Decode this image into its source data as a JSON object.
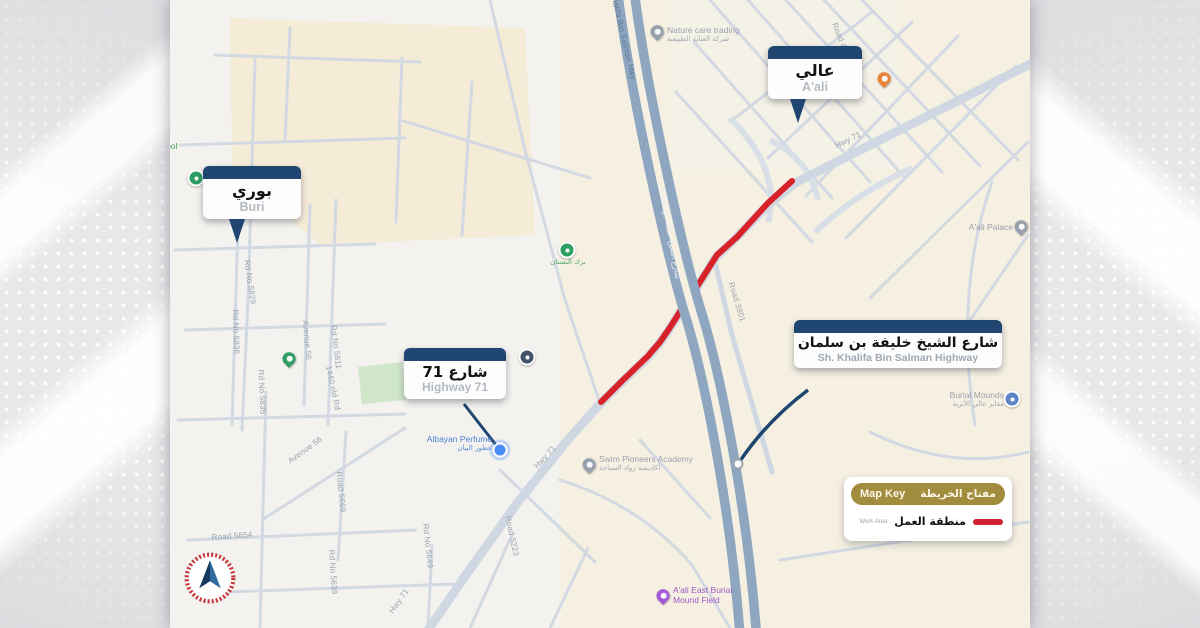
{
  "map": {
    "callouts": {
      "aali": {
        "ar": "عالي",
        "en": "A'ali"
      },
      "buri": {
        "ar": "بوري",
        "en": "Buri"
      },
      "highway71": {
        "ar": "شارع 71",
        "en": "Highway 71"
      },
      "khalifa": {
        "ar": "شارع الشيخ خليفة بن سلمان",
        "en": "Sh. Khalifa Bin Salman Highway"
      }
    },
    "key": {
      "title_en": "Map Key",
      "title_ar": "مفتاح الخريطة",
      "work_area_en": "Work Area",
      "work_area_ar": "منطقة العمل",
      "swatch_color": "#cf2030"
    },
    "colors": {
      "callout_header": "#1e4670",
      "key_header": "#a28c3e",
      "work_area_route": "#d8222a",
      "highway": "#8ea6c0"
    },
    "pois": [
      {
        "name": "nature-care-trading",
        "icon": "pin",
        "color": "#97a1ad",
        "x": 487,
        "y": 33,
        "dx": 10,
        "dy": -8,
        "align": "left",
        "label_color": "#98a1ac",
        "label_en": "Nature care trading",
        "label_ar": "شركة العناية الطبيعية"
      },
      {
        "name": "pool-label",
        "icon": "none",
        "x": 0,
        "y": 147,
        "dx": -4,
        "dy": -6,
        "align": "left",
        "label_color": "#3f9e58",
        "label_en": "ool",
        "label_ar": ""
      },
      {
        "name": "bustan-ponds",
        "icon": "circle-badge",
        "color": "#2f9e63",
        "x": 397,
        "y": 250,
        "dx": -55,
        "dy": 8,
        "align": "center",
        "label_color": "#3f9e58",
        "label_en": "",
        "label_ar": "برك البستان"
      },
      {
        "name": "mosque-buri",
        "icon": "circle-badge",
        "color": "#2f9e63",
        "x": 26,
        "y": 178,
        "label_en": "",
        "label_ar": ""
      },
      {
        "name": "mosque-park",
        "icon": "pin",
        "color": "#2f9e63",
        "x": 119,
        "y": 360,
        "label_en": "",
        "label_ar": ""
      },
      {
        "name": "albayan-perfume",
        "icon": "dot",
        "color": "#4a8af4",
        "x": 330,
        "y": 450,
        "dx": -120,
        "dy": -16,
        "align": "right",
        "label_color": "#4a7fd4",
        "label_en": "Albayan Perfume",
        "label_ar": "عطور البيان"
      },
      {
        "name": "swim-pioneers-academy",
        "icon": "pin",
        "color": "#97a1ad",
        "x": 419,
        "y": 466,
        "dx": 10,
        "dy": -12,
        "align": "left",
        "label_color": "#98a1ac",
        "label_en": "Swim Pioneers Academy",
        "label_ar": "أكاديمية رواد السباحة"
      },
      {
        "name": "aali-palace",
        "icon": "pin",
        "color": "#97a1ad",
        "x": 851,
        "y": 228,
        "dx": -120,
        "dy": -6,
        "align": "right",
        "label_color": "#98a1ac",
        "label_en": "A'ali Palace",
        "label_ar": ""
      },
      {
        "name": "burial-mounds",
        "icon": "circle-badge",
        "color": "#5b84c4",
        "x": 842,
        "y": 399,
        "dx": -120,
        "dy": -9,
        "align": "right",
        "label_color": "#98a1ac",
        "label_en": "Burial Mounds",
        "label_ar": "مقابر عالي الأثرية"
      },
      {
        "name": "aali-east-burial-mound-field",
        "icon": "pin",
        "color": "#a558d8",
        "x": 493,
        "y": 597,
        "dx": 10,
        "dy": -12,
        "align": "left",
        "label_color": "#9b59c7",
        "label_en": "A'ali East Burial\nMound Field",
        "label_ar": ""
      },
      {
        "name": "restaurant-aali",
        "icon": "pin",
        "color": "#e8833a",
        "x": 714,
        "y": 80,
        "label_en": "",
        "label_ar": ""
      },
      {
        "name": "poi-marker-navy",
        "icon": "circle-badge",
        "color": "#44536b",
        "x": 357,
        "y": 357,
        "label_en": "",
        "label_ar": ""
      }
    ],
    "road_labels": [
      {
        "text": "Hwy 71",
        "x": 678,
        "y": 140,
        "rot": -27
      },
      {
        "text": "Road 4042",
        "x": 672,
        "y": 42,
        "rot": 68
      },
      {
        "text": "Hwy 71",
        "x": 375,
        "y": 457,
        "rot": -48
      },
      {
        "text": "Hwy 71",
        "x": 229,
        "y": 601,
        "rot": -55
      },
      {
        "text": "Road 3801",
        "x": 567,
        "y": 302,
        "rot": 73
      },
      {
        "text": "Rd No 5829",
        "x": 80,
        "y": 282,
        "rot": 82
      },
      {
        "text": "Rd No 5836",
        "x": 66,
        "y": 332,
        "rot": 88
      },
      {
        "text": "Avenue 56",
        "x": 137,
        "y": 340,
        "rot": 85
      },
      {
        "text": "Rd No 5811",
        "x": 166,
        "y": 347,
        "rot": 83
      },
      {
        "text": "1440 old Rd",
        "x": 163,
        "y": 388,
        "rot": 78
      },
      {
        "text": "Rd No 5835",
        "x": 92,
        "y": 392,
        "rot": 87
      },
      {
        "text": "Avenue 56",
        "x": 135,
        "y": 450,
        "rot": -36
      },
      {
        "text": "Road 5669",
        "x": 171,
        "y": 492,
        "rot": 84
      },
      {
        "text": "Road 5654",
        "x": 62,
        "y": 536,
        "rot": -4
      },
      {
        "text": "Rd No 5649",
        "x": 258,
        "y": 546,
        "rot": 84
      },
      {
        "text": "Road 5223",
        "x": 342,
        "y": 536,
        "rot": 78
      },
      {
        "text": "Rd No 5639",
        "x": 163,
        "y": 572,
        "rot": 86
      },
      {
        "text": "Sh Khalifa Bin Salman Hwy",
        "x": 452,
        "y": 30,
        "rot": 77,
        "color": "#5d7590"
      },
      {
        "text": "شارع الشيخ خليفة بن سلمان",
        "x": 500,
        "y": 232,
        "rot": 80,
        "color": "#eef2f7"
      }
    ]
  }
}
